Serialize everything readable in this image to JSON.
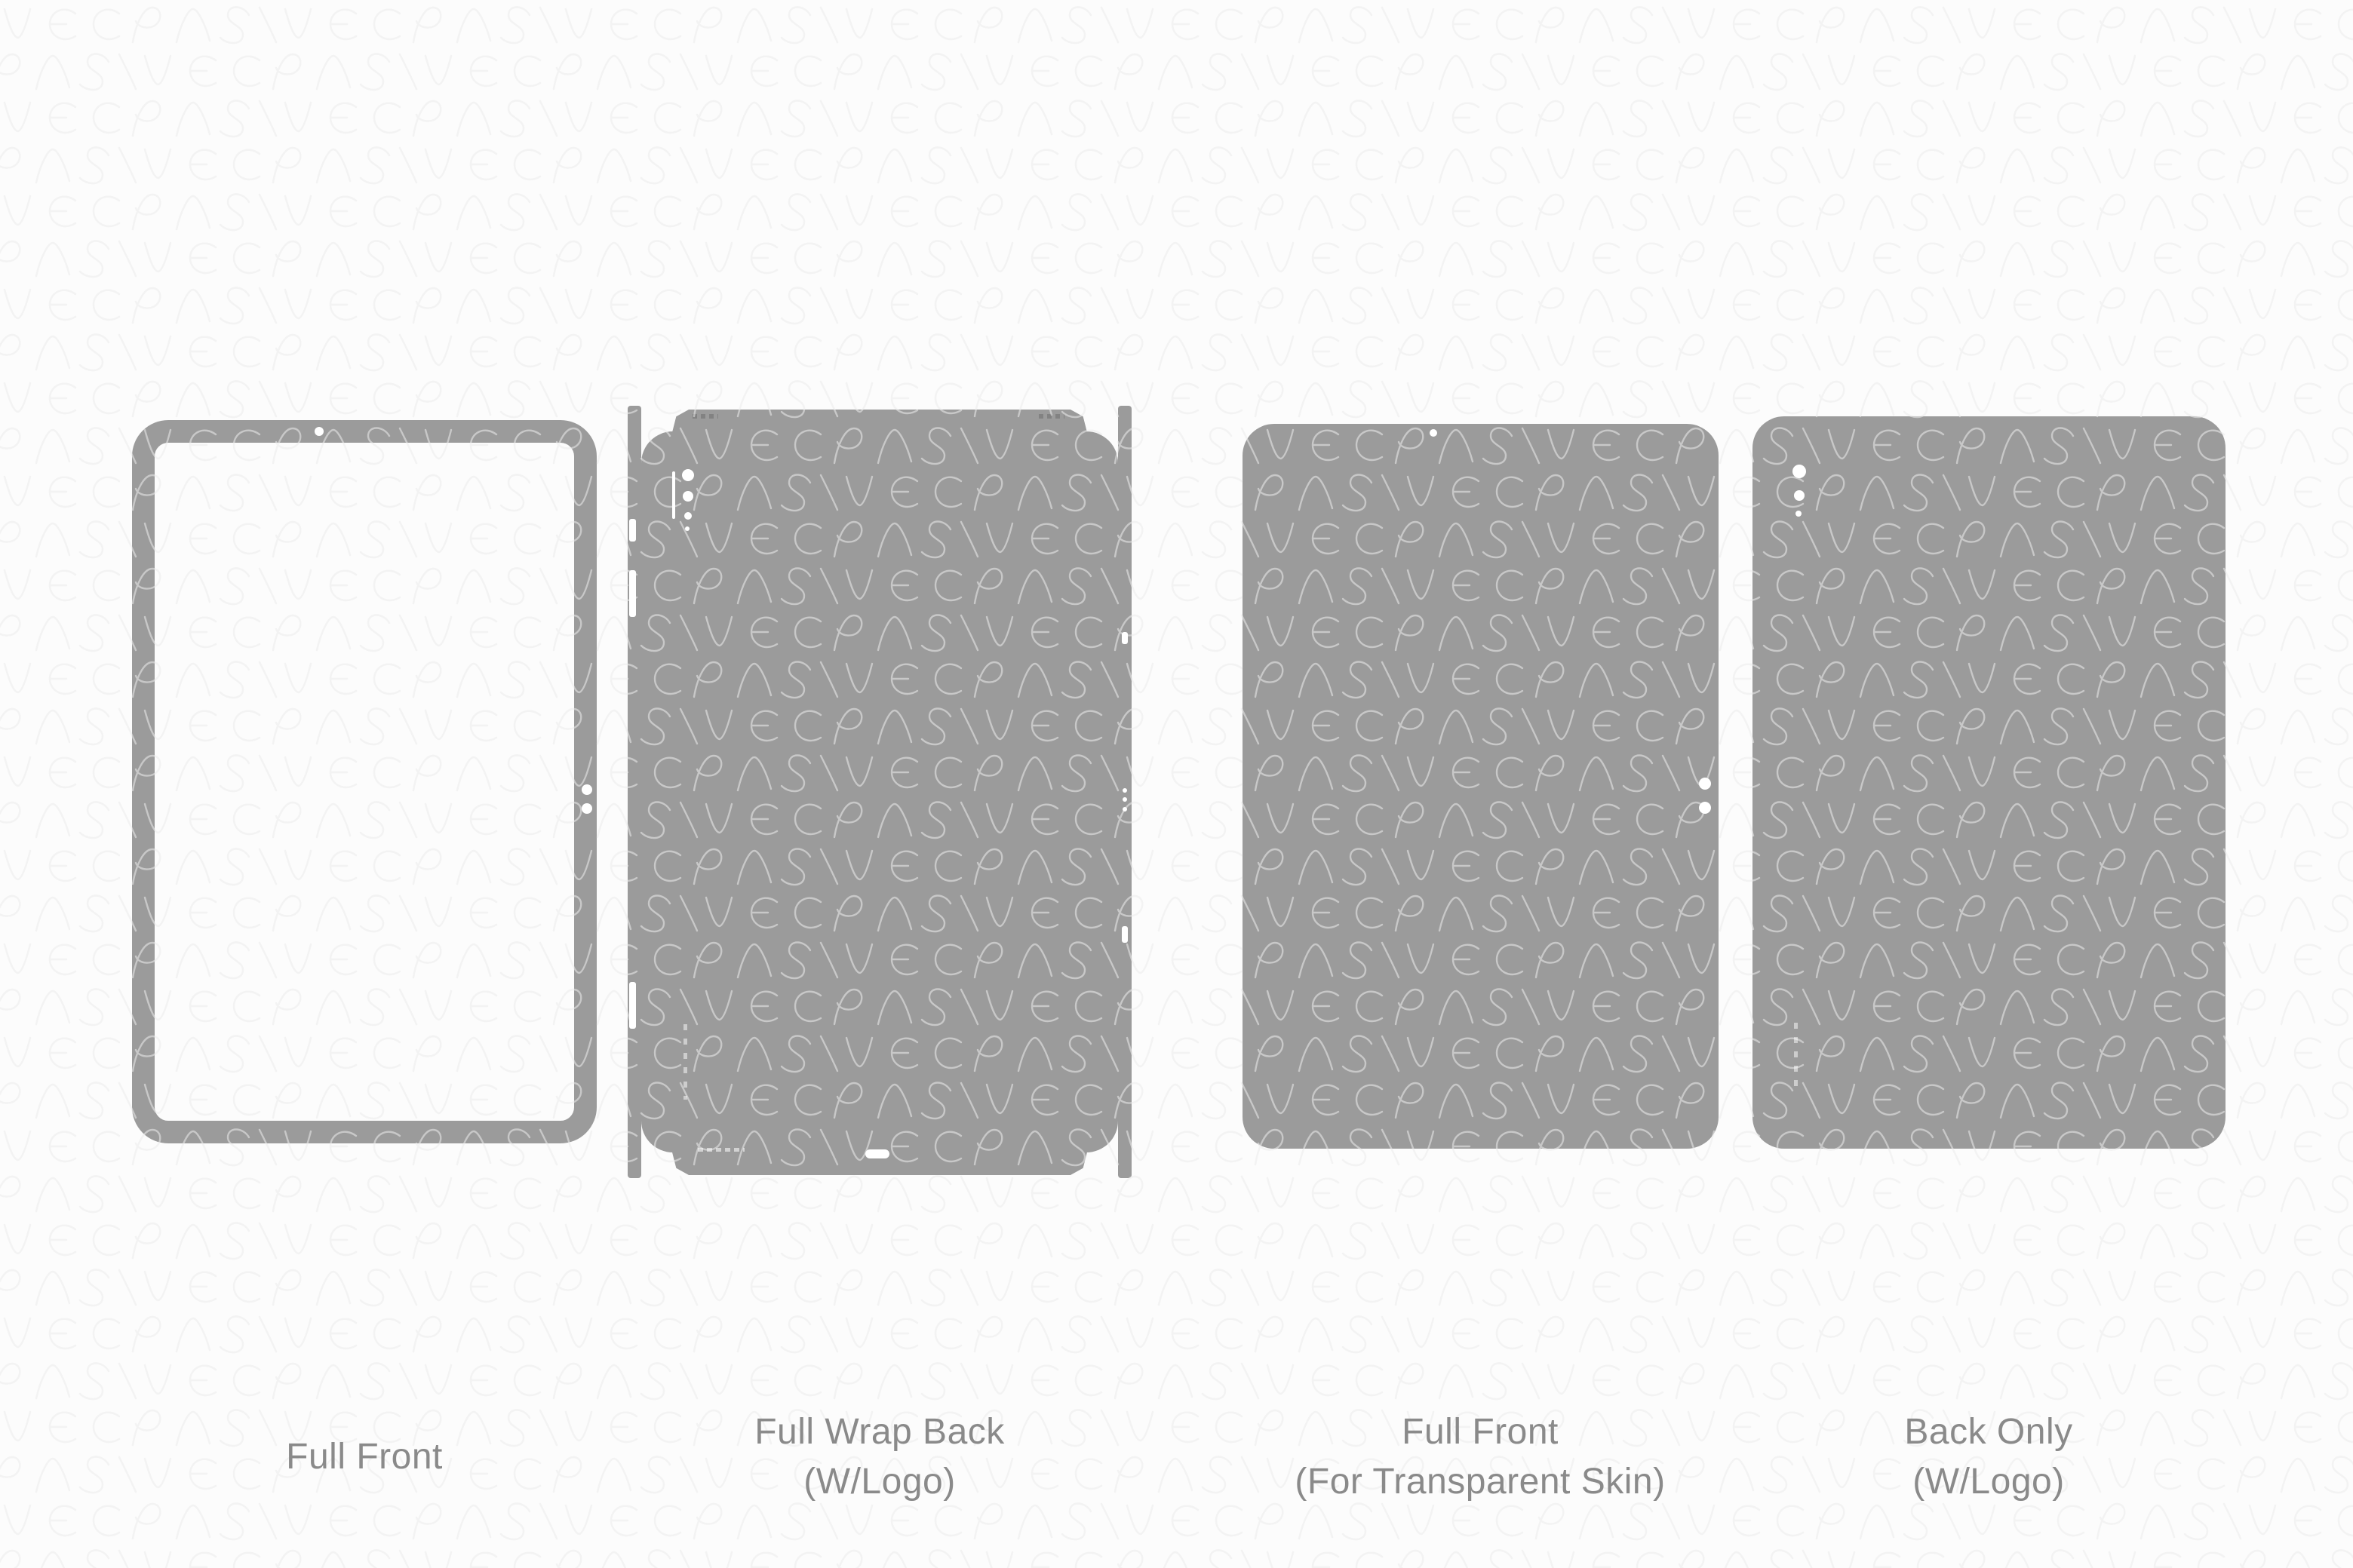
{
  "page": {
    "kind": "skin-template-sheet",
    "device_templates_count": "4"
  },
  "watermark": {
    "brand_text": "VECRAS"
  },
  "colors": {
    "shape_gray": "#9b9b9b",
    "caption_gray": "#8a8a8a",
    "background": "#fcfcfc",
    "watermark_stroke": "#e9e9e9",
    "watermark_overlay": "rgba(255,255,255,0.45)"
  },
  "templates": [
    {
      "id": "full-front",
      "label_lines": [
        "Full Front",
        ""
      ]
    },
    {
      "id": "full-wrap-back",
      "label_lines": [
        "Full Wrap Back",
        "(W/Logo)"
      ]
    },
    {
      "id": "full-front-transparent",
      "label_lines": [
        "Full Front",
        "(For Transparent Skin)"
      ]
    },
    {
      "id": "back-only",
      "label_lines": [
        "Back Only",
        "(W/Logo)"
      ]
    }
  ]
}
